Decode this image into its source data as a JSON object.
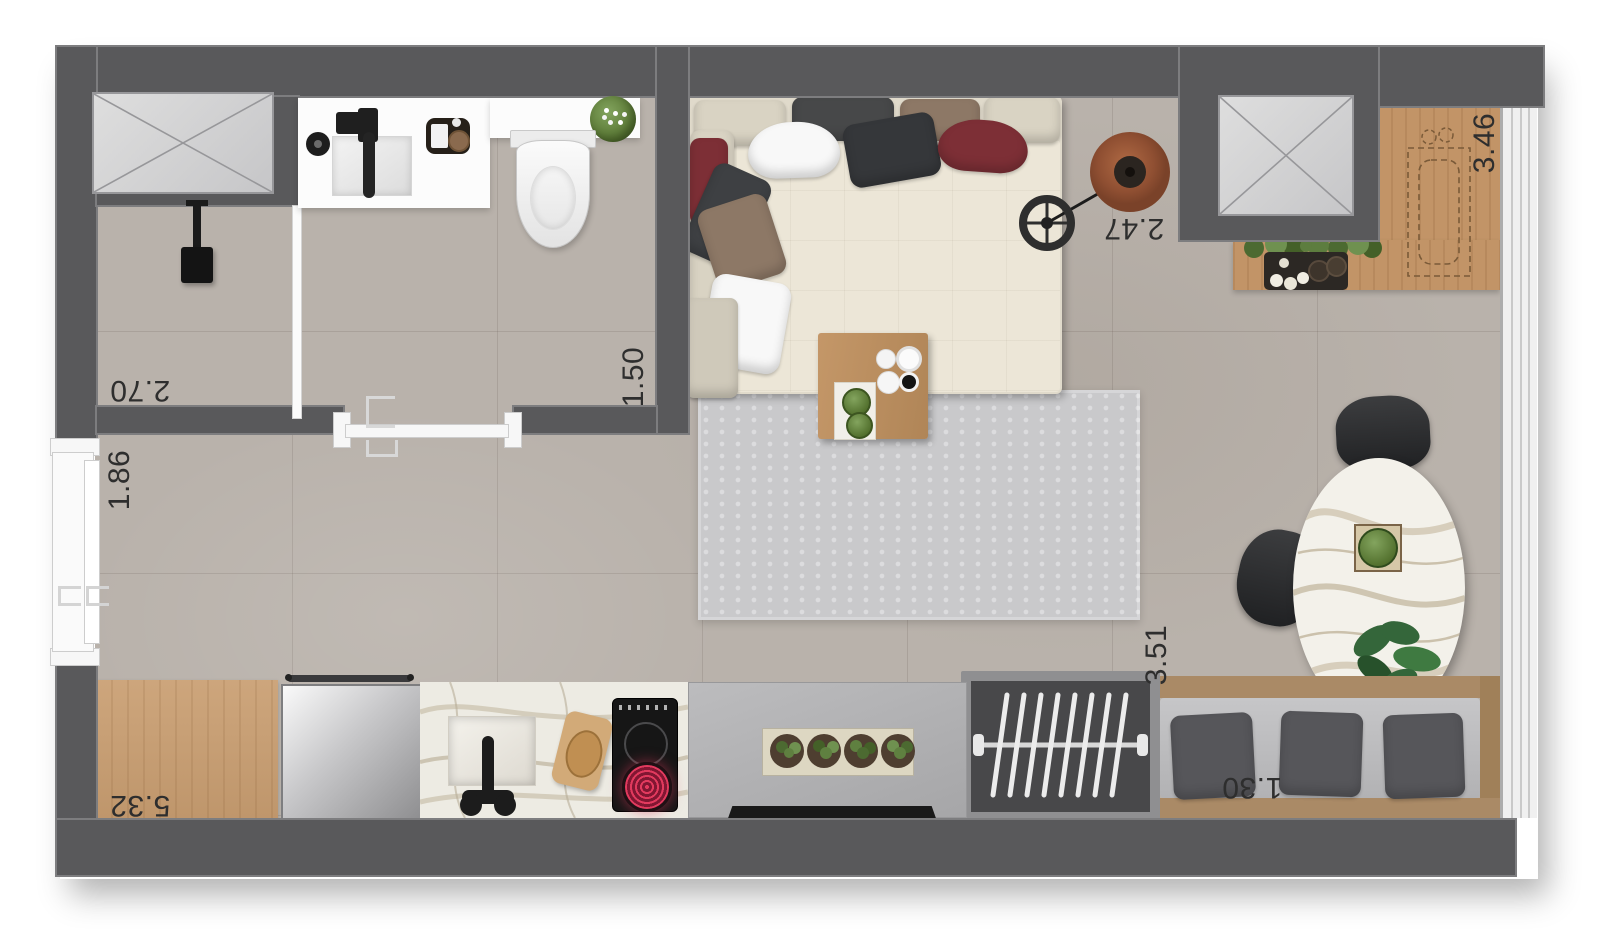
{
  "plan": {
    "title": "studio apartment floor plan (top view render)",
    "dims": {
      "shower_room": "2.70",
      "bathroom": "1.50",
      "entry_door": "1.86",
      "living_room": "2.47",
      "kitchen_top": "3.46",
      "living_length": "3.51",
      "kitchen_run": "5.32",
      "bench": "1.30"
    },
    "colors": {
      "wall": "#59595b",
      "floor_tile": "#b9b2ab",
      "wood": "#c99e71",
      "sofa_beige": "#e9e3d4",
      "pillow_red": "#7d2f36",
      "pillow_charcoal": "#36383a",
      "rug": "#c9c9cb",
      "marble": "#f0eee8",
      "furniture_black": "#2e2f31",
      "plant_green": "#5f8040",
      "cooktop_coil_red": "#d63053",
      "label_text": "#2e2e2e"
    },
    "items": [
      "service-shaft",
      "shower",
      "toilet",
      "vanity-sink",
      "sliding-door",
      "entry-sliding-door",
      "corner-sofa",
      "arc-floor-lamp",
      "coffee-table",
      "area-rug",
      "dining-table",
      "dining-chairs",
      "bench-seat",
      "wardrobe-hangers",
      "sideboard-desk",
      "herb-planter",
      "refrigerator",
      "kitchen-sink",
      "cooktop",
      "cutting-board",
      "window-wall",
      "counter-tray",
      "dashed-appliance-outline"
    ]
  }
}
